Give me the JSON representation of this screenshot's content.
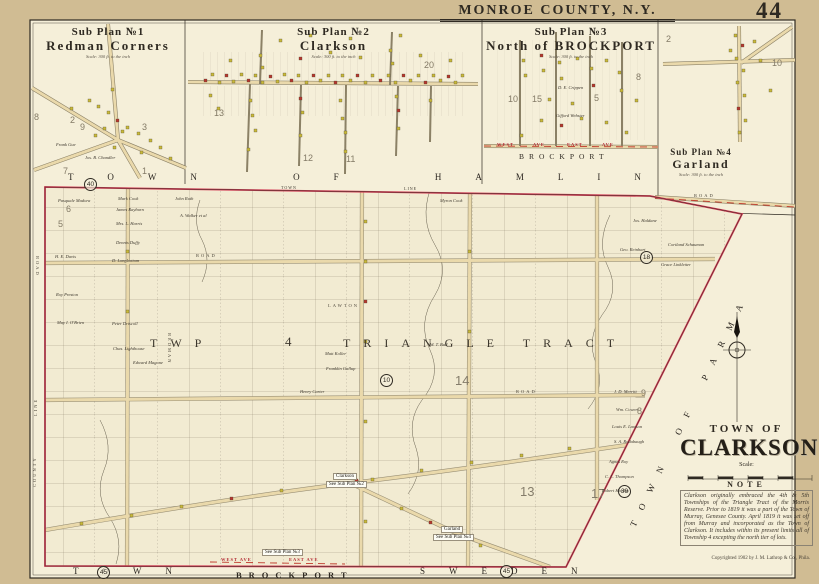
{
  "header": {
    "county_title": "MONROE COUNTY, N.Y.",
    "page_number": "44"
  },
  "sub_plans": [
    {
      "no": "Sub Plan №1",
      "name": "Redman Corners",
      "scale": "Scale: 300 ft. to the inch"
    },
    {
      "no": "Sub Plan №2",
      "name": "Clarkson",
      "scale": "Scale: 300 ft. to the inch"
    },
    {
      "no": "Sub Plan №3",
      "name": "North of BROCKPORT",
      "scale": "Scale: 300 ft. to the inch"
    },
    {
      "no": "Sub Plan №4",
      "name": "Garland",
      "scale": "Scale: 300 ft. to the inch"
    }
  ],
  "title_block": {
    "town_of": "TOWN OF",
    "town_name": "CLARKSON",
    "scale_label": "Scale:",
    "note_title": "NOTE",
    "note_text": "Clarkson originally embraced the 4th & 5th Townships of the Triangle Tract of the Morris Reserve. Prior to 1819 it was a part of the Town of Murray, Genesee County. April 1819 it was set off from Murray and incorporated as the Town of Clarkson. It includes within its present limits all of Township 4 excepting the north tier of lots.",
    "copyright": "Copyrighted 1902 by J. M. Lathrop & Co., Phila."
  },
  "map_labels": [
    {
      "t": "TOWN OF HAMLIN",
      "x": 68,
      "y": 172,
      "c": "border",
      "n": "border-label-hamlin"
    },
    {
      "t": "TOWN",
      "x": 281,
      "y": 185,
      "c": "tinybl",
      "n": "town-line-label"
    },
    {
      "t": "LINE",
      "x": 404,
      "y": 186,
      "c": "tinybl",
      "n": "town-line-label"
    },
    {
      "t": "TOWN OF PARMA",
      "x": 628,
      "y": 524,
      "c": "diagb",
      "r": -64,
      "n": "border-label-parma"
    },
    {
      "t": "TOWN",
      "x": 73,
      "y": 566,
      "c": "bottomb",
      "n": "border-label-town"
    },
    {
      "t": "BROCKPORT",
      "x": 236,
      "y": 570,
      "c": "brockport",
      "n": "border-label-brockport"
    },
    {
      "t": "SWEDEN",
      "x": 420,
      "y": 566,
      "c": "bottomb",
      "n": "border-label-sweden"
    },
    {
      "t": "45",
      "x": 97,
      "y": 566,
      "c": "cnum",
      "n": "plate-ref-number"
    },
    {
      "t": "45",
      "x": 500,
      "y": 565,
      "c": "cnum",
      "n": "plate-ref-number"
    },
    {
      "t": "40",
      "x": 84,
      "y": 178,
      "c": "cnum",
      "n": "plate-ref-number"
    },
    {
      "t": "39",
      "x": 618,
      "y": 485,
      "c": "cnum",
      "n": "plate-ref-number"
    },
    {
      "t": "18",
      "x": 640,
      "y": 251,
      "c": "cnum",
      "n": "lot-number"
    },
    {
      "t": "10",
      "x": 380,
      "y": 374,
      "c": "cnum",
      "n": "lot-number"
    },
    {
      "t": "13",
      "x": 520,
      "y": 484,
      "c": "bignum",
      "n": "lot-number"
    },
    {
      "t": "17",
      "x": 591,
      "y": 486,
      "c": "bignum",
      "n": "lot-number"
    },
    {
      "t": "14",
      "x": 455,
      "y": 373,
      "c": "bignum",
      "n": "lot-number"
    },
    {
      "t": "TWP",
      "x": 150,
      "y": 336,
      "c": "twp",
      "n": "township-label"
    },
    {
      "t": "4",
      "x": 285,
      "y": 334,
      "c": "twp4",
      "n": "township-number"
    },
    {
      "t": "TRIANGLE TRACT",
      "x": 343,
      "y": 336,
      "c": "twp",
      "n": "tract-label"
    },
    {
      "t": "Pasquale Madora",
      "x": 58,
      "y": 198,
      "c": "own",
      "n": "owner-name"
    },
    {
      "t": "Mark Cook",
      "x": 118,
      "y": 196,
      "c": "own",
      "n": "owner-name"
    },
    {
      "t": "John Ruth",
      "x": 175,
      "y": 196,
      "c": "own",
      "n": "owner-name"
    },
    {
      "t": "James Rayburn",
      "x": 116,
      "y": 207,
      "c": "own",
      "n": "owner-name"
    },
    {
      "t": "A. Walker et al",
      "x": 180,
      "y": 213,
      "c": "own",
      "n": "owner-name"
    },
    {
      "t": "Mrs. L. Harris",
      "x": 116,
      "y": 221,
      "c": "own",
      "n": "owner-name"
    },
    {
      "t": "Myron Cook",
      "x": 440,
      "y": 198,
      "c": "own",
      "n": "owner-name"
    },
    {
      "t": "Dennis Duffy",
      "x": 116,
      "y": 240,
      "c": "own",
      "n": "owner-name"
    },
    {
      "t": "H. E. Davis",
      "x": 55,
      "y": 254,
      "c": "own",
      "n": "owner-name"
    },
    {
      "t": "D. Longbottom",
      "x": 112,
      "y": 258,
      "c": "own",
      "n": "owner-name"
    },
    {
      "t": "Roy Preston",
      "x": 56,
      "y": 292,
      "c": "own",
      "n": "owner-name"
    },
    {
      "t": "May I. O'Brien",
      "x": 57,
      "y": 320,
      "c": "own",
      "n": "owner-name"
    },
    {
      "t": "Peter Driscoll",
      "x": 112,
      "y": 321,
      "c": "own",
      "n": "owner-name"
    },
    {
      "t": "Chas. Lighthouse",
      "x": 113,
      "y": 346,
      "c": "own",
      "n": "owner-name"
    },
    {
      "t": "Edward Magone",
      "x": 133,
      "y": 360,
      "c": "own",
      "n": "owner-name"
    },
    {
      "t": "Matt Koller",
      "x": 325,
      "y": 351,
      "c": "own",
      "n": "owner-name"
    },
    {
      "t": "Franklin Gallup",
      "x": 326,
      "y": 366,
      "c": "own",
      "n": "owner-name"
    },
    {
      "t": "W. T. Ball",
      "x": 430,
      "y": 342,
      "c": "own",
      "n": "owner-name"
    },
    {
      "t": "Henry Carter",
      "x": 300,
      "y": 389,
      "c": "own",
      "n": "owner-name"
    },
    {
      "t": "Jos. Haldane",
      "x": 633,
      "y": 218,
      "c": "own",
      "n": "owner-name"
    },
    {
      "t": "Geo. Reinhart",
      "x": 620,
      "y": 247,
      "c": "own",
      "n": "owner-name"
    },
    {
      "t": "Cortland Schauman",
      "x": 668,
      "y": 242,
      "c": "own",
      "n": "owner-name"
    },
    {
      "t": "Grace Linkletter",
      "x": 661,
      "y": 262,
      "c": "own",
      "n": "owner-name"
    },
    {
      "t": "J. D. Merritt",
      "x": 614,
      "y": 389,
      "c": "own",
      "n": "owner-name"
    },
    {
      "t": "Wm. Cowen",
      "x": 616,
      "y": 407,
      "c": "own",
      "n": "owner-name"
    },
    {
      "t": "Louis E. Lawson",
      "x": 612,
      "y": 424,
      "c": "own",
      "n": "owner-name"
    },
    {
      "t": "S. A. Rodabaugh",
      "x": 614,
      "y": 439,
      "c": "own",
      "n": "owner-name"
    },
    {
      "t": "Agnes Roy",
      "x": 609,
      "y": 459,
      "c": "own",
      "n": "owner-name"
    },
    {
      "t": "C. L. Thompson",
      "x": 605,
      "y": 474,
      "c": "own",
      "n": "owner-name"
    },
    {
      "t": "Robert Hartley",
      "x": 602,
      "y": 488,
      "c": "own",
      "n": "owner-name"
    },
    {
      "t": "Frank Gue",
      "x": 56,
      "y": 142,
      "c": "own",
      "n": "owner-name"
    },
    {
      "t": "Jos. B. Chandler",
      "x": 85,
      "y": 155,
      "c": "own",
      "n": "owner-name"
    },
    {
      "t": "D. E. Crippen",
      "x": 558,
      "y": 85,
      "c": "own",
      "n": "owner-name"
    },
    {
      "t": "Gifford Webster",
      "x": 556,
      "y": 113,
      "c": "own",
      "n": "owner-name"
    },
    {
      "t": "8",
      "x": 34,
      "y": 112,
      "c": "bignum2",
      "n": "lot-number"
    },
    {
      "t": "2",
      "x": 70,
      "y": 115,
      "c": "bignum2",
      "n": "lot-number"
    },
    {
      "t": "9",
      "x": 80,
      "y": 122,
      "c": "bignum2",
      "n": "lot-number"
    },
    {
      "t": "3",
      "x": 142,
      "y": 122,
      "c": "bignum2",
      "n": "lot-number"
    },
    {
      "t": "7",
      "x": 63,
      "y": 166,
      "c": "bignum2",
      "n": "lot-number"
    },
    {
      "t": "1",
      "x": 142,
      "y": 166,
      "c": "bignum2",
      "n": "lot-number"
    },
    {
      "t": "20",
      "x": 424,
      "y": 60,
      "c": "bignum2",
      "n": "lot-number"
    },
    {
      "t": "13",
      "x": 214,
      "y": 108,
      "c": "bignum2",
      "n": "lot-number"
    },
    {
      "t": "12",
      "x": 303,
      "y": 153,
      "c": "bignum2",
      "n": "lot-number"
    },
    {
      "t": "11",
      "x": 346,
      "y": 154,
      "c": "bignum2",
      "n": "lot-number"
    },
    {
      "t": "10",
      "x": 508,
      "y": 94,
      "c": "bignum2",
      "n": "lot-number"
    },
    {
      "t": "15",
      "x": 532,
      "y": 94,
      "c": "bignum2",
      "n": "lot-number"
    },
    {
      "t": "5",
      "x": 594,
      "y": 93,
      "c": "bignum2",
      "n": "lot-number"
    },
    {
      "t": "8",
      "x": 636,
      "y": 72,
      "c": "bignum2",
      "n": "lot-number"
    },
    {
      "t": "2",
      "x": 666,
      "y": 34,
      "c": "bignum2",
      "n": "lot-number"
    },
    {
      "t": "10",
      "x": 772,
      "y": 58,
      "c": "bignum2",
      "n": "lot-number"
    },
    {
      "t": "9",
      "x": 641,
      "y": 388,
      "c": "bignum2",
      "n": "lot-number"
    },
    {
      "t": "8",
      "x": 637,
      "y": 406,
      "c": "bignum2",
      "n": "lot-number"
    },
    {
      "t": "6",
      "x": 66,
      "y": 204,
      "c": "bignum2",
      "n": "lot-number"
    },
    {
      "t": "5",
      "x": 58,
      "y": 219,
      "c": "bignum2",
      "n": "lot-number"
    },
    {
      "t": "Clarkson",
      "x": 333,
      "y": 473,
      "c": "patch",
      "n": "village-ref-clarkson"
    },
    {
      "t": "See Sub Plan №2",
      "x": 326,
      "y": 481,
      "c": "patch",
      "n": "village-ref-clarkson"
    },
    {
      "t": "Garland",
      "x": 441,
      "y": 526,
      "c": "patch",
      "n": "village-ref-garland"
    },
    {
      "t": "See Sub Plan №4",
      "x": 433,
      "y": 534,
      "c": "patch",
      "n": "village-ref-garland"
    },
    {
      "t": "See Sub Plan №3",
      "x": 262,
      "y": 549,
      "c": "patch",
      "n": "village-ref-brockport"
    },
    {
      "t": "WEST AVE",
      "x": 221,
      "y": 557,
      "c": "ave",
      "n": "street-label"
    },
    {
      "t": "EAST AVE",
      "x": 289,
      "y": 557,
      "c": "ave",
      "n": "street-label"
    },
    {
      "t": "WEST",
      "x": 497,
      "y": 142,
      "c": "ave",
      "n": "street-label"
    },
    {
      "t": "AVE",
      "x": 533,
      "y": 142,
      "c": "ave",
      "n": "street-label"
    },
    {
      "t": "EAST",
      "x": 567,
      "y": 142,
      "c": "ave",
      "n": "street-label"
    },
    {
      "t": "AVE",
      "x": 602,
      "y": 142,
      "c": "ave",
      "n": "street-label"
    },
    {
      "t": "BROCKPORT",
      "x": 519,
      "y": 152,
      "c": "brockport2",
      "n": "village-label-brockport"
    },
    {
      "t": "ROAD",
      "x": 196,
      "y": 253,
      "c": "roadlb",
      "n": "road-label"
    },
    {
      "t": "ROAD",
      "x": 516,
      "y": 389,
      "c": "roadlb",
      "n": "road-label"
    },
    {
      "t": "ROAD",
      "x": 694,
      "y": 193,
      "c": "roadlb",
      "n": "road-label"
    },
    {
      "t": "LAWTON",
      "x": 328,
      "y": 303,
      "c": "roadlb",
      "n": "road-label"
    },
    {
      "t": "ROAD",
      "x": 40,
      "y": 256,
      "c": "roadlb",
      "r": 90,
      "n": "road-label"
    },
    {
      "t": "REDMAN",
      "x": 172,
      "y": 333,
      "c": "roadlb",
      "r": 90,
      "n": "road-label"
    },
    {
      "t": "LINE",
      "x": 33,
      "y": 416,
      "c": "roadlb",
      "r": -90,
      "n": "county-line-label"
    },
    {
      "t": "COUNTY",
      "x": 32,
      "y": 487,
      "c": "roadlb",
      "r": -90,
      "n": "county-line-label"
    }
  ],
  "buildings": [
    [
      88,
      99,
      "y"
    ],
    [
      97,
      105,
      "y"
    ],
    [
      107,
      111,
      "y"
    ],
    [
      116,
      119,
      "r"
    ],
    [
      126,
      126,
      "y"
    ],
    [
      137,
      132,
      "y"
    ],
    [
      149,
      139,
      "y"
    ],
    [
      159,
      146,
      "y"
    ],
    [
      111,
      88,
      "y"
    ],
    [
      103,
      127,
      "y"
    ],
    [
      94,
      134,
      "y"
    ],
    [
      140,
      151,
      "y"
    ],
    [
      70,
      107,
      "y"
    ],
    [
      169,
      157,
      "y"
    ],
    [
      121,
      130,
      "y"
    ],
    [
      113,
      146,
      "y"
    ],
    [
      204,
      79,
      "r"
    ],
    [
      211,
      73,
      "y"
    ],
    [
      218,
      81,
      "y"
    ],
    [
      225,
      74,
      "r"
    ],
    [
      232,
      80,
      "y"
    ],
    [
      240,
      73,
      "y"
    ],
    [
      247,
      79,
      "r"
    ],
    [
      254,
      74,
      "y"
    ],
    [
      261,
      81,
      "y"
    ],
    [
      269,
      75,
      "r"
    ],
    [
      276,
      80,
      "y"
    ],
    [
      283,
      73,
      "y"
    ],
    [
      290,
      79,
      "r"
    ],
    [
      297,
      74,
      "y"
    ],
    [
      305,
      81,
      "y"
    ],
    [
      312,
      74,
      "r"
    ],
    [
      319,
      79,
      "y"
    ],
    [
      327,
      74,
      "y"
    ],
    [
      334,
      81,
      "r"
    ],
    [
      341,
      74,
      "y"
    ],
    [
      349,
      79,
      "y"
    ],
    [
      356,
      74,
      "r"
    ],
    [
      364,
      81,
      "y"
    ],
    [
      371,
      74,
      "y"
    ],
    [
      379,
      79,
      "r"
    ],
    [
      387,
      74,
      "y"
    ],
    [
      394,
      81,
      "y"
    ],
    [
      402,
      74,
      "r"
    ],
    [
      409,
      79,
      "y"
    ],
    [
      417,
      74,
      "y"
    ],
    [
      424,
      81,
      "r"
    ],
    [
      432,
      74,
      "y"
    ],
    [
      439,
      79,
      "y"
    ],
    [
      447,
      75,
      "r"
    ],
    [
      454,
      81,
      "y"
    ],
    [
      461,
      74,
      "y"
    ],
    [
      249,
      99,
      "y"
    ],
    [
      251,
      114,
      "y"
    ],
    [
      299,
      97,
      "r"
    ],
    [
      301,
      111,
      "y"
    ],
    [
      339,
      99,
      "y"
    ],
    [
      341,
      117,
      "y"
    ],
    [
      395,
      95,
      "y"
    ],
    [
      397,
      109,
      "r"
    ],
    [
      429,
      99,
      "y"
    ],
    [
      254,
      129,
      "y"
    ],
    [
      299,
      134,
      "y"
    ],
    [
      344,
      131,
      "y"
    ],
    [
      397,
      127,
      "y"
    ],
    [
      209,
      94,
      "y"
    ],
    [
      217,
      107,
      "y"
    ],
    [
      247,
      148,
      "y"
    ],
    [
      344,
      150,
      "y"
    ],
    [
      229,
      59,
      "y"
    ],
    [
      259,
      54,
      "y"
    ],
    [
      299,
      57,
      "r"
    ],
    [
      329,
      51,
      "y"
    ],
    [
      359,
      56,
      "y"
    ],
    [
      389,
      49,
      "y"
    ],
    [
      419,
      54,
      "y"
    ],
    [
      449,
      59,
      "y"
    ],
    [
      279,
      39,
      "y"
    ],
    [
      309,
      34,
      "y"
    ],
    [
      349,
      37,
      "y"
    ],
    [
      399,
      34,
      "y"
    ],
    [
      261,
      66,
      "y"
    ],
    [
      391,
      62,
      "y"
    ],
    [
      522,
      59,
      "y"
    ],
    [
      524,
      74,
      "y"
    ],
    [
      540,
      54,
      "r"
    ],
    [
      542,
      69,
      "y"
    ],
    [
      558,
      61,
      "y"
    ],
    [
      560,
      77,
      "y"
    ],
    [
      576,
      57,
      "y"
    ],
    [
      590,
      67,
      "y"
    ],
    [
      592,
      84,
      "r"
    ],
    [
      605,
      59,
      "y"
    ],
    [
      618,
      71,
      "y"
    ],
    [
      620,
      89,
      "y"
    ],
    [
      635,
      99,
      "y"
    ],
    [
      540,
      119,
      "y"
    ],
    [
      560,
      124,
      "r"
    ],
    [
      580,
      117,
      "y"
    ],
    [
      605,
      121,
      "y"
    ],
    [
      520,
      134,
      "y"
    ],
    [
      625,
      131,
      "y"
    ],
    [
      548,
      98,
      "y"
    ],
    [
      571,
      102,
      "y"
    ],
    [
      734,
      34,
      "y"
    ],
    [
      741,
      44,
      "r"
    ],
    [
      735,
      57,
      "y"
    ],
    [
      742,
      69,
      "y"
    ],
    [
      736,
      81,
      "y"
    ],
    [
      743,
      94,
      "y"
    ],
    [
      737,
      107,
      "r"
    ],
    [
      744,
      119,
      "y"
    ],
    [
      738,
      131,
      "y"
    ],
    [
      729,
      49,
      "y"
    ],
    [
      759,
      59,
      "y"
    ],
    [
      769,
      89,
      "y"
    ],
    [
      753,
      40,
      "y"
    ],
    [
      80,
      522,
      "y"
    ],
    [
      130,
      514,
      "y"
    ],
    [
      180,
      505,
      "y"
    ],
    [
      230,
      497,
      "r"
    ],
    [
      280,
      489,
      "y"
    ],
    [
      331,
      484,
      "y"
    ],
    [
      355,
      479,
      "r"
    ],
    [
      371,
      478,
      "y"
    ],
    [
      420,
      469,
      "y"
    ],
    [
      470,
      461,
      "y"
    ],
    [
      520,
      454,
      "y"
    ],
    [
      568,
      447,
      "y"
    ],
    [
      364,
      220,
      "y"
    ],
    [
      364,
      260,
      "y"
    ],
    [
      364,
      300,
      "r"
    ],
    [
      364,
      340,
      "y"
    ],
    [
      364,
      420,
      "y"
    ],
    [
      364,
      520,
      "y"
    ],
    [
      400,
      507,
      "y"
    ],
    [
      429,
      521,
      "r"
    ],
    [
      459,
      536,
      "y"
    ],
    [
      479,
      544,
      "y"
    ],
    [
      126,
      250,
      "y"
    ],
    [
      126,
      310,
      "y"
    ],
    [
      468,
      250,
      "y"
    ],
    [
      468,
      330,
      "y"
    ]
  ]
}
